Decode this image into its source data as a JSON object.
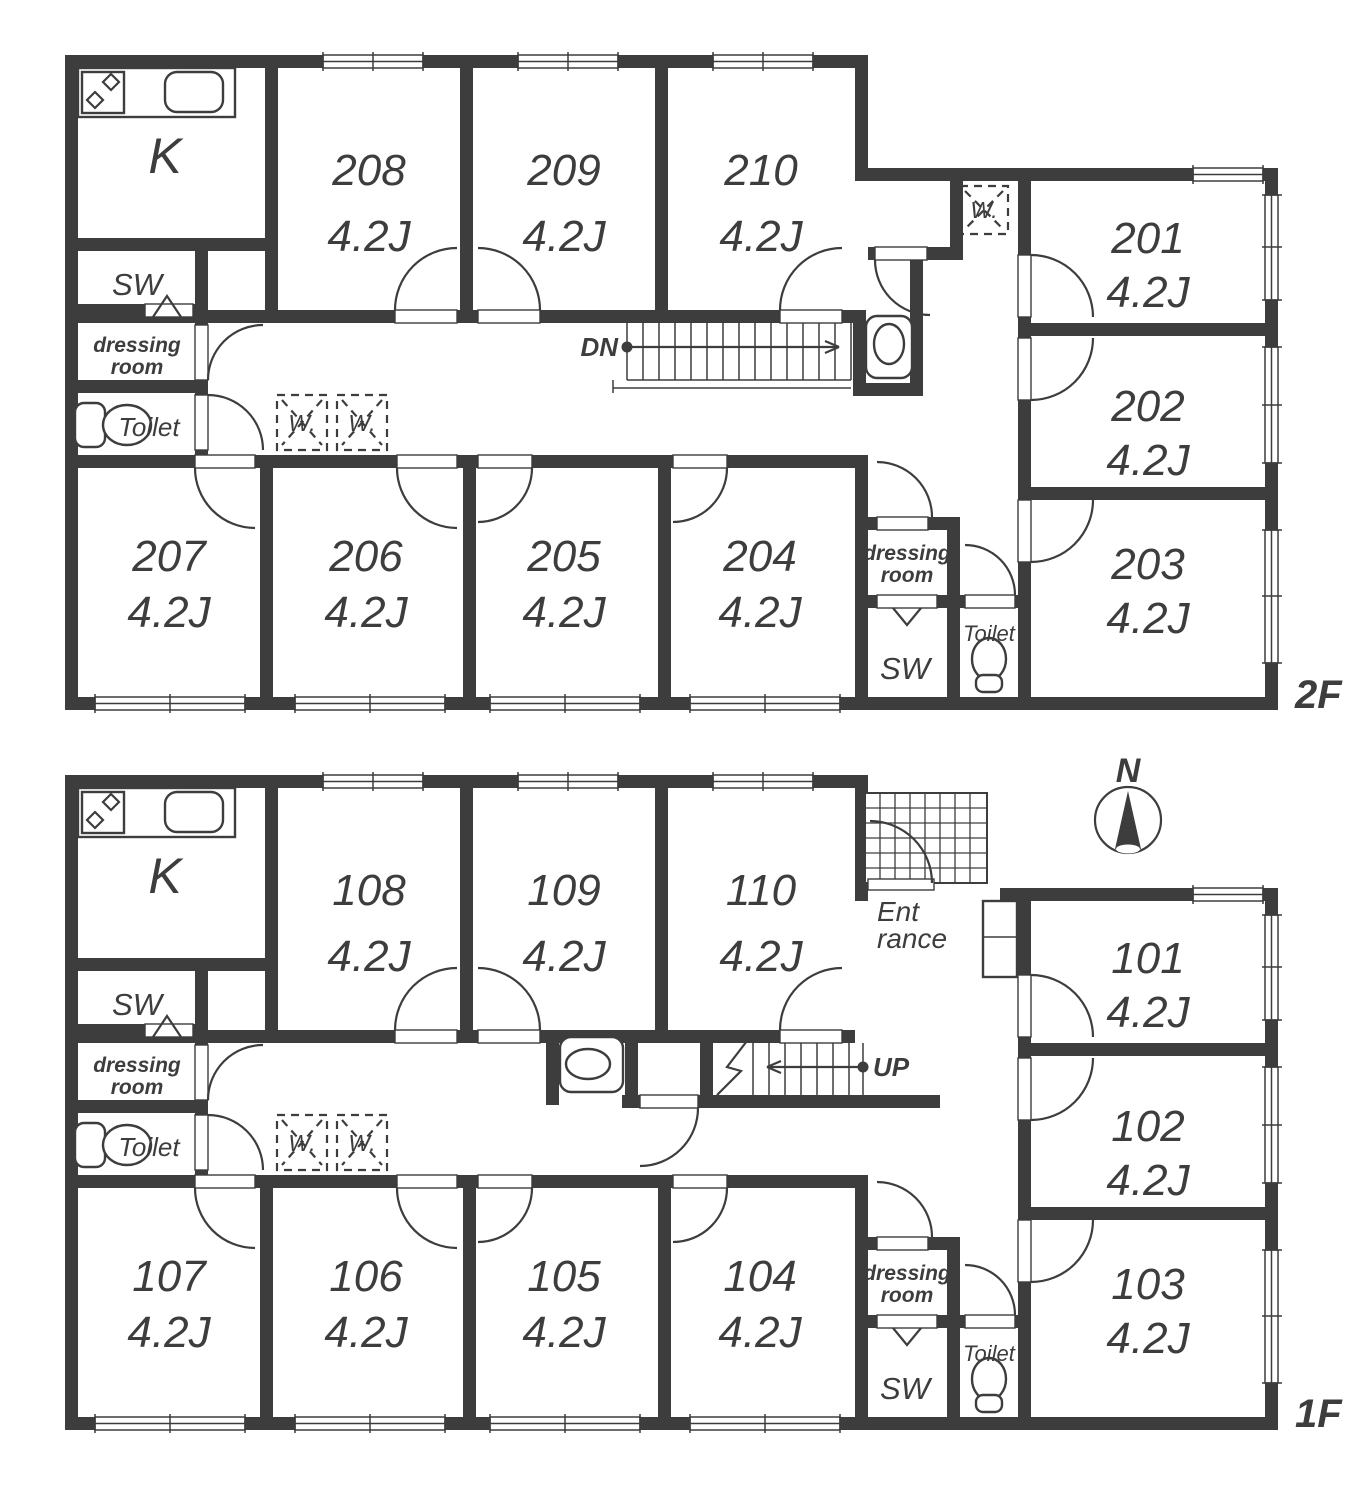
{
  "colors": {
    "line": "#3d3d3d",
    "background": "#ffffff"
  },
  "labels": {
    "kitchen": "K",
    "storage": "SW",
    "dressing_line1": "dressing",
    "dressing_line2": "room",
    "toilet": "Toilet",
    "washer": "W.",
    "down": "DN",
    "up": "UP",
    "entrance_line1": "Ent",
    "entrance_line2": "rance",
    "north": "N"
  },
  "floors": [
    {
      "name": "2F",
      "stair_direction": "DN",
      "rooms": [
        {
          "no": "208",
          "size": "4.2J"
        },
        {
          "no": "209",
          "size": "4.2J"
        },
        {
          "no": "210",
          "size": "4.2J"
        },
        {
          "no": "201",
          "size": "4.2J"
        },
        {
          "no": "202",
          "size": "4.2J"
        },
        {
          "no": "203",
          "size": "4.2J"
        },
        {
          "no": "207",
          "size": "4.2J"
        },
        {
          "no": "206",
          "size": "4.2J"
        },
        {
          "no": "205",
          "size": "4.2J"
        },
        {
          "no": "204",
          "size": "4.2J"
        }
      ]
    },
    {
      "name": "1F",
      "stair_direction": "UP",
      "rooms": [
        {
          "no": "108",
          "size": "4.2J"
        },
        {
          "no": "109",
          "size": "4.2J"
        },
        {
          "no": "110",
          "size": "4.2J"
        },
        {
          "no": "101",
          "size": "4.2J"
        },
        {
          "no": "102",
          "size": "4.2J"
        },
        {
          "no": "103",
          "size": "4.2J"
        },
        {
          "no": "107",
          "size": "4.2J"
        },
        {
          "no": "106",
          "size": "4.2J"
        },
        {
          "no": "105",
          "size": "4.2J"
        },
        {
          "no": "104",
          "size": "4.2J"
        }
      ]
    }
  ]
}
